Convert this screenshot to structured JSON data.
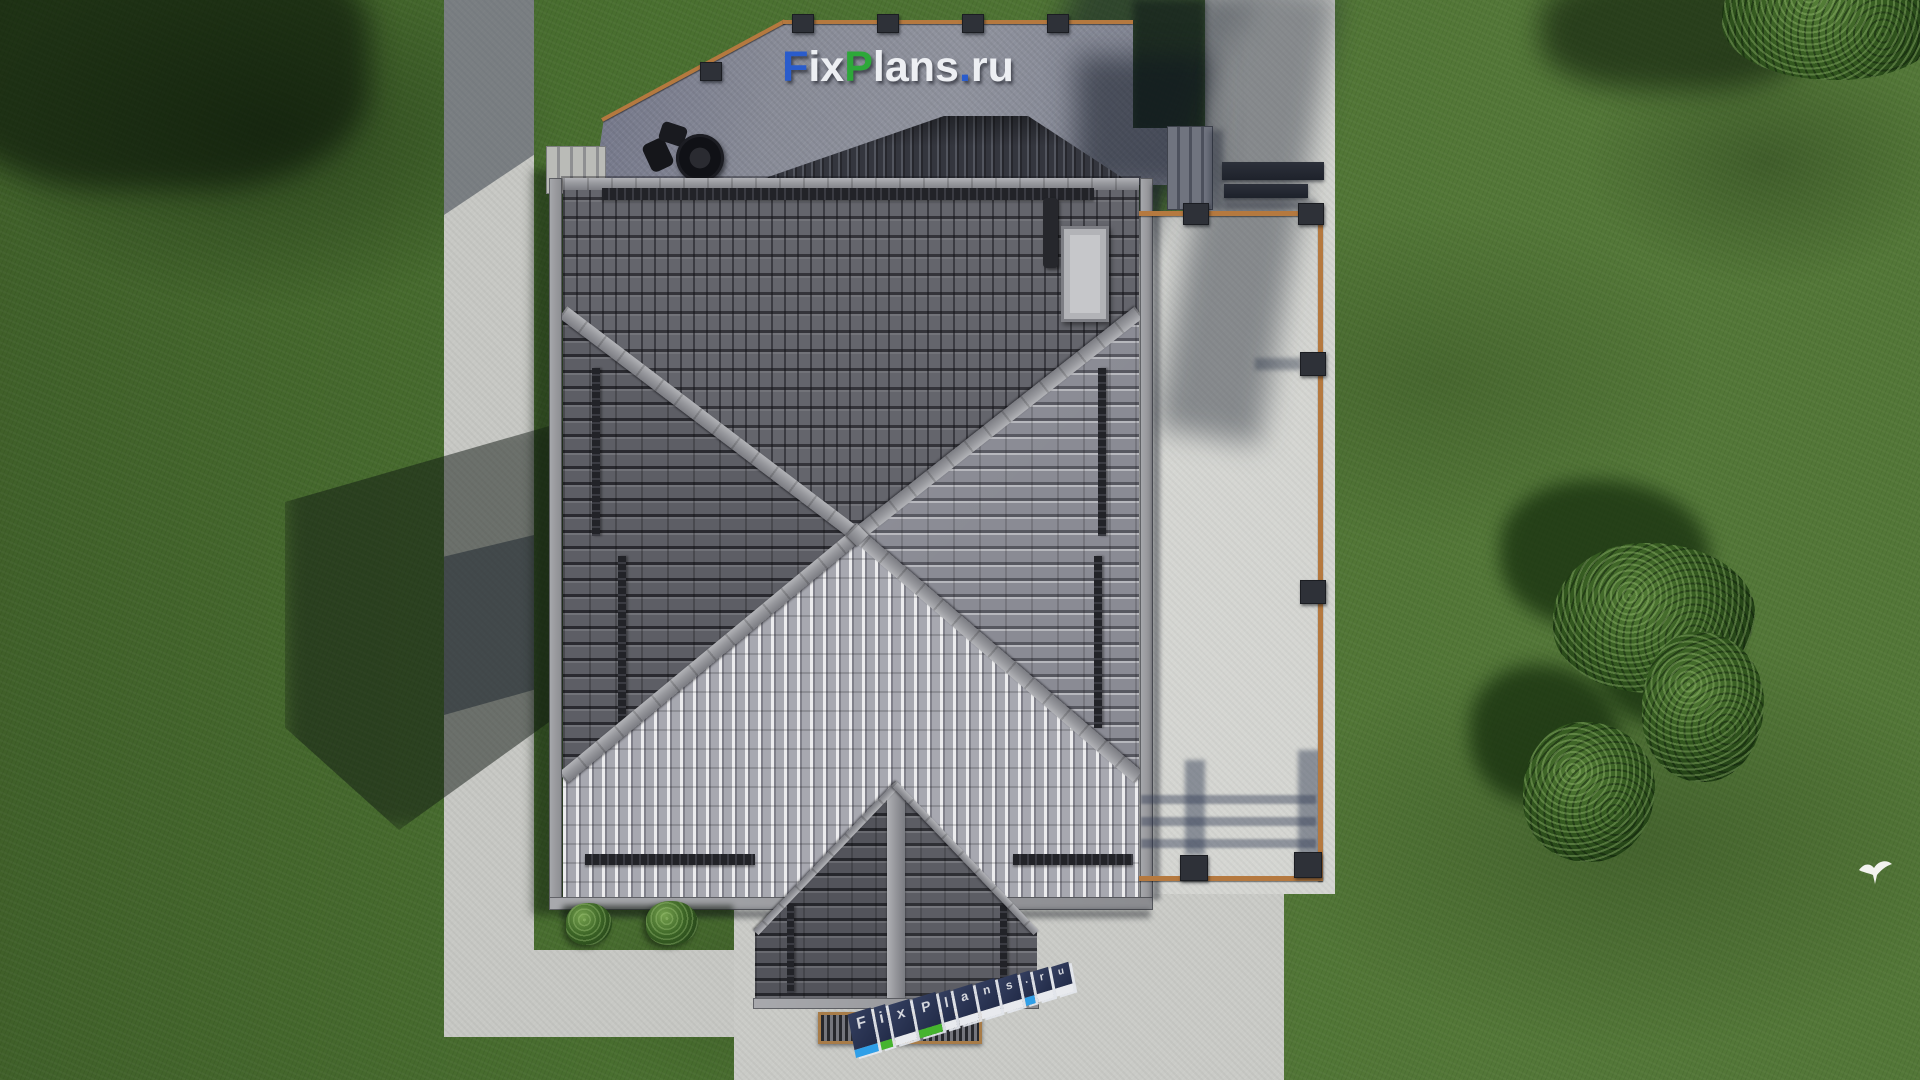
{
  "scene": {
    "name": "aerial-roof-plan-render",
    "description": "Top-down 3D architectural render of a hip-roof house with terraces, paths, lawn and trees"
  },
  "watermark": {
    "text": "FixPlans.ru",
    "segments": [
      {
        "text": "F",
        "color": "#2a5ccc"
      },
      {
        "text": "ix",
        "color": "#edeff3"
      },
      {
        "text": "P",
        "color": "#2da839"
      },
      {
        "text": "lans",
        "color": "#edeff3"
      },
      {
        "text": ".",
        "color": "#2a5ccc"
      },
      {
        "text": "ru",
        "color": "#edeff3"
      }
    ]
  },
  "ground_sign": {
    "text": "FixPlans.ru",
    "letters": [
      {
        "ch": "F",
        "face": "#2f9fe8",
        "w": 24
      },
      {
        "ch": "i",
        "face": "#45b42e",
        "w": 12
      },
      {
        "ch": "x",
        "face": "#e8eaee",
        "w": 22
      },
      {
        "ch": "P",
        "face": "#45b42e",
        "w": 24
      },
      {
        "ch": "l",
        "face": "#e8eaee",
        "w": 12
      },
      {
        "ch": "a",
        "face": "#e8eaee",
        "w": 20
      },
      {
        "ch": "n",
        "face": "#e8eaee",
        "w": 20
      },
      {
        "ch": "s",
        "face": "#e8eaee",
        "w": 20
      },
      {
        "ch": ".",
        "face": "#2f9fe8",
        "w": 10
      },
      {
        "ch": "r",
        "face": "#e8eaee",
        "w": 16
      },
      {
        "ch": "u",
        "face": "#e8eaee",
        "w": 18
      }
    ]
  },
  "palette": {
    "grass": "#4a7030",
    "grass_shadow": "#203a14",
    "path_concrete": "#c7c8c4",
    "patio_concrete": "#d5d6d2",
    "terrace_concrete": "#8d909b",
    "roof_top_face": "#64656c",
    "roof_left_face": "#5d5e65",
    "roof_right_face": "#8a8b94",
    "roof_bottom_face": "#a7a8b0",
    "ridge_cap": "#97989d",
    "upper_gable_tiles": "#34363e",
    "railing_wood": "#b5793f",
    "brand_blue": "#2a5ccc",
    "brand_green": "#2da839"
  }
}
